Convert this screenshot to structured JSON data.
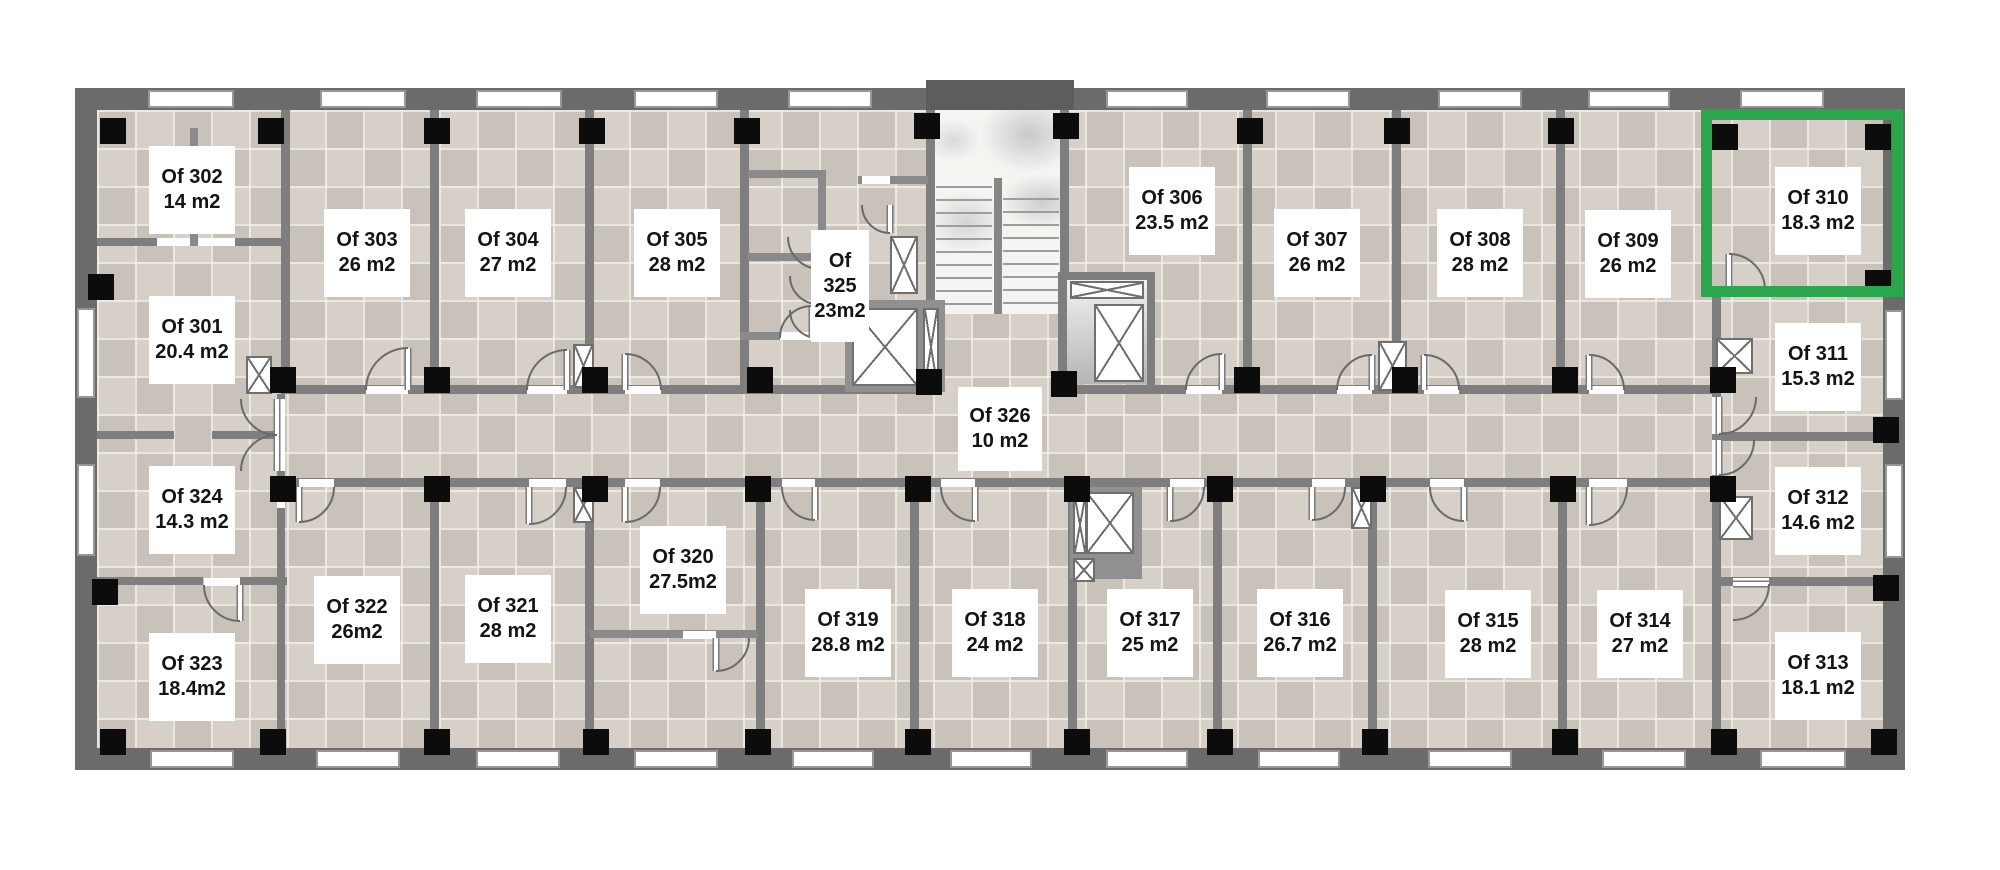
{
  "plan": {
    "highlight_color": "#2ca64d",
    "selected_room_id": "310",
    "selected_room_label": "Of 310",
    "unit": "m2",
    "wall_color": "#6b6b6b",
    "floor_color": "#d2cbc2",
    "column_color": "#0c0c0c"
  },
  "rooms": [
    {
      "id": "301",
      "lines": [
        "Of 301",
        "20.4 m2"
      ],
      "area": "20.4 m2",
      "highlighted": false
    },
    {
      "id": "302",
      "lines": [
        "Of 302",
        "14 m2"
      ],
      "area": "14 m2",
      "highlighted": false
    },
    {
      "id": "303",
      "lines": [
        "Of 303",
        "26 m2"
      ],
      "area": "26 m2",
      "highlighted": false
    },
    {
      "id": "304",
      "lines": [
        "Of 304",
        "27 m2"
      ],
      "area": "27 m2",
      "highlighted": false
    },
    {
      "id": "305",
      "lines": [
        "Of 305",
        "28 m2"
      ],
      "area": "28 m2",
      "highlighted": false
    },
    {
      "id": "306",
      "lines": [
        "Of 306",
        "23.5 m2"
      ],
      "area": "23.5 m2",
      "highlighted": false
    },
    {
      "id": "307",
      "lines": [
        "Of 307",
        "26 m2"
      ],
      "area": "26 m2",
      "highlighted": false
    },
    {
      "id": "308",
      "lines": [
        "Of 308",
        "28 m2"
      ],
      "area": "28 m2",
      "highlighted": false
    },
    {
      "id": "309",
      "lines": [
        "Of 309",
        "26 m2"
      ],
      "area": "26 m2",
      "highlighted": false
    },
    {
      "id": "310",
      "lines": [
        "Of 310",
        "18.3 m2"
      ],
      "area": "18.3 m2",
      "highlighted": true
    },
    {
      "id": "311",
      "lines": [
        "Of 311",
        "15.3 m2"
      ],
      "area": "15.3 m2",
      "highlighted": false
    },
    {
      "id": "312",
      "lines": [
        "Of 312",
        "14.6 m2"
      ],
      "area": "14.6 m2",
      "highlighted": false
    },
    {
      "id": "313",
      "lines": [
        "Of 313",
        "18.1 m2"
      ],
      "area": "18.1 m2",
      "highlighted": false
    },
    {
      "id": "314",
      "lines": [
        "Of 314",
        "27 m2"
      ],
      "area": "27 m2",
      "highlighted": false
    },
    {
      "id": "315",
      "lines": [
        "Of 315",
        "28 m2"
      ],
      "area": "28 m2",
      "highlighted": false
    },
    {
      "id": "316",
      "lines": [
        "Of 316",
        "26.7 m2"
      ],
      "area": "26.7 m2",
      "highlighted": false
    },
    {
      "id": "317",
      "lines": [
        "Of 317",
        "25 m2"
      ],
      "area": "25 m2",
      "highlighted": false
    },
    {
      "id": "318",
      "lines": [
        "Of 318",
        "24 m2"
      ],
      "area": "24 m2",
      "highlighted": false
    },
    {
      "id": "319",
      "lines": [
        "Of 319",
        "28.8 m2"
      ],
      "area": "28.8 m2",
      "highlighted": false
    },
    {
      "id": "320",
      "lines": [
        "Of 320",
        "27.5m2"
      ],
      "area": "27.5m2",
      "highlighted": false
    },
    {
      "id": "321",
      "lines": [
        "Of 321",
        "28 m2"
      ],
      "area": "28 m2",
      "highlighted": false
    },
    {
      "id": "322",
      "lines": [
        "Of 322",
        "26m2"
      ],
      "area": "26m2",
      "highlighted": false
    },
    {
      "id": "323",
      "lines": [
        "Of 323",
        "18.4m2"
      ],
      "area": "18.4m2",
      "highlighted": false
    },
    {
      "id": "324",
      "lines": [
        "Of 324",
        "14.3 m2"
      ],
      "area": "14.3 m2",
      "highlighted": false
    },
    {
      "id": "325",
      "lines": [
        "Of",
        "325",
        "23m2"
      ],
      "area": "23m2",
      "highlighted": false
    },
    {
      "id": "326",
      "lines": [
        "Of 326",
        "10 m2"
      ],
      "area": "10 m2",
      "highlighted": false
    }
  ]
}
